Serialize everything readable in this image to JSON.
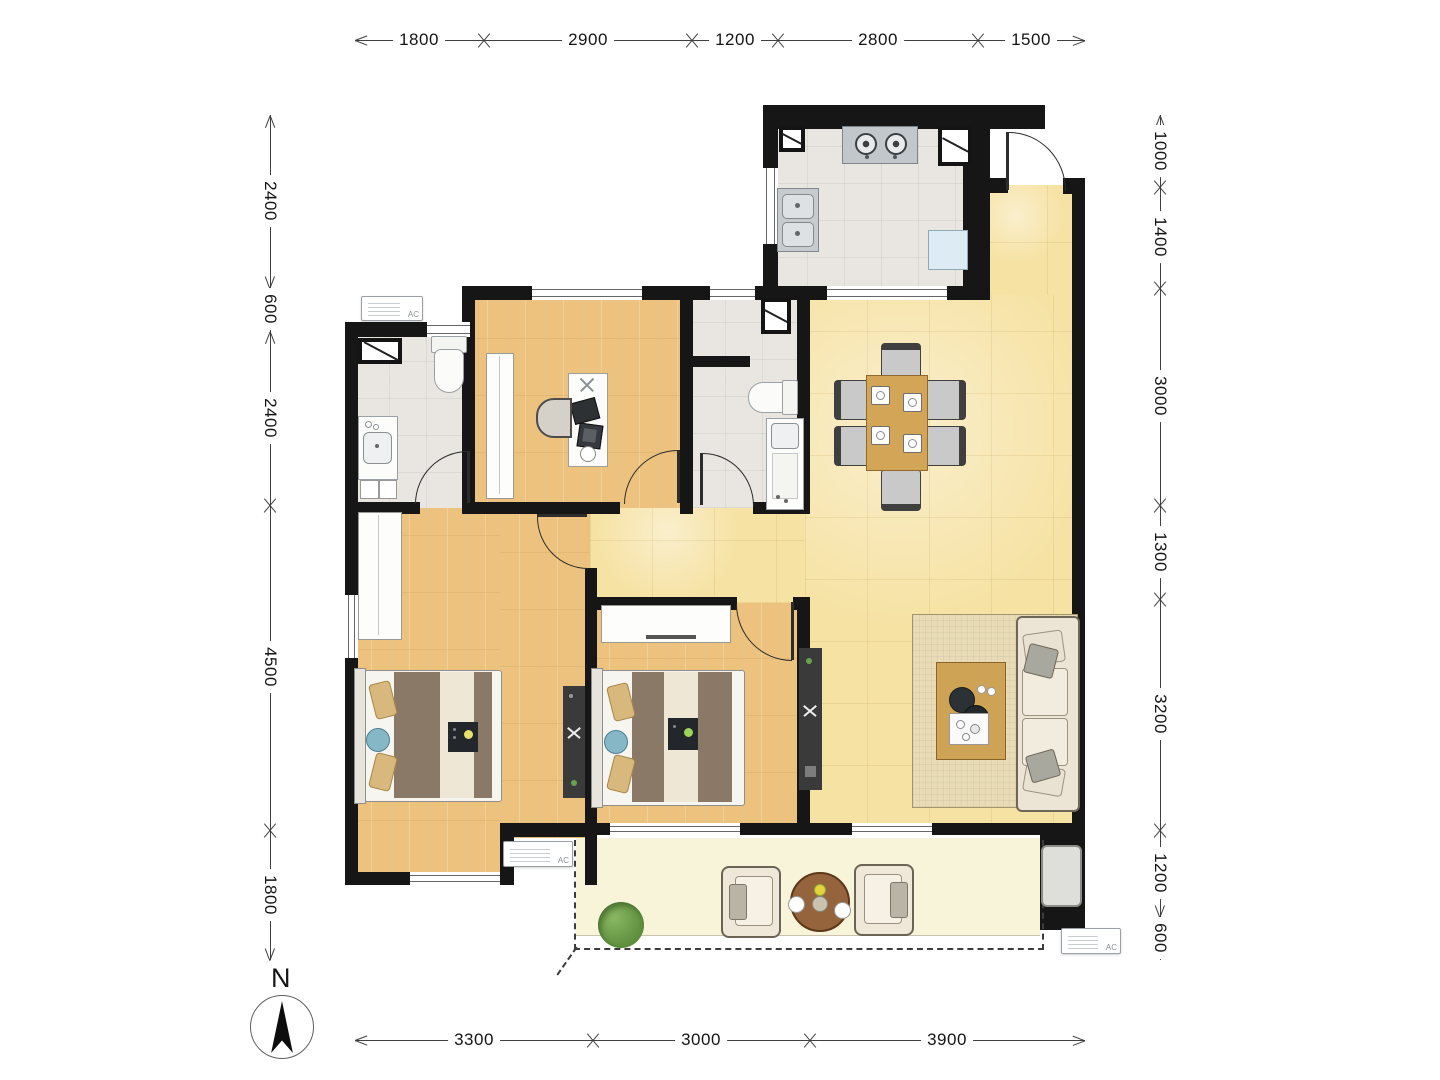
{
  "compass": {
    "label": "N"
  },
  "hvac": {
    "ac_label": "AC"
  },
  "dimensions": {
    "top": [
      "1800",
      "2900",
      "1200",
      "2800",
      "1500"
    ],
    "left": [
      "2400",
      "600",
      "2400",
      "4500",
      "1800"
    ],
    "right": [
      "1000",
      "1400",
      "3000",
      "1300",
      "3200",
      "1200",
      "600"
    ],
    "bottom": [
      "3300",
      "3000",
      "3900"
    ]
  },
  "colors": {
    "wall": "#161616",
    "wood_floor": "#ecc27e",
    "warm_tile": "#f6e2a3",
    "grey_tile": "#e9e6e1",
    "balcony_floor": "#f7f4da",
    "dim_line": "#3f3f3f"
  }
}
